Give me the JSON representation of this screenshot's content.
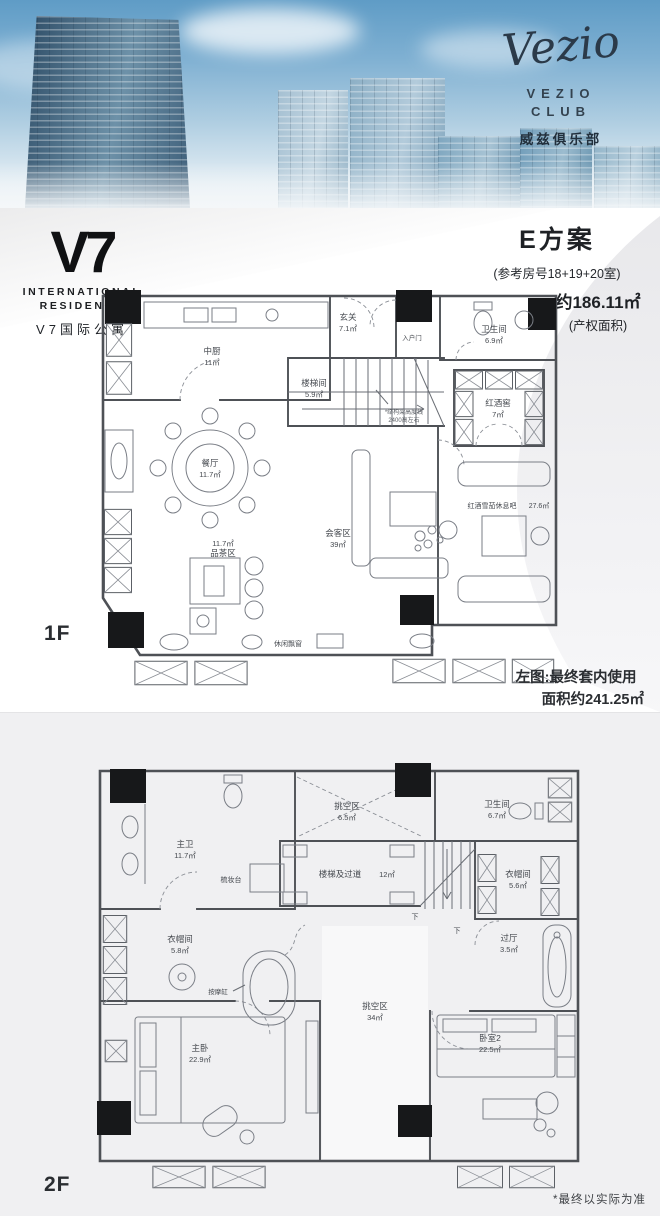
{
  "colors": {
    "sky": "#5f9cc6",
    "plan_line": "#4e5156",
    "column_fill": "#17181a",
    "bottom_section_bg": "#f0f0f2",
    "text_dark": "#1e2125"
  },
  "hero": {
    "brand_script": "Vezio",
    "brand_name": "VEZIO",
    "brand_sub": "CLUB",
    "brand_cn": "威兹俱乐部"
  },
  "logo": {
    "main": "V7",
    "line1": "INTERNATIONAL",
    "line2": "RESIDENCE",
    "cn": "V7国际公寓"
  },
  "plan_header": {
    "title": "E方案",
    "subtitle": "(参考房号18+19+20室)",
    "area": "约186.11㎡",
    "area_note": "(产权面积)"
  },
  "floor1": {
    "label": "1F",
    "note_line1": "左图:最终套内使用",
    "note_line2": "面积约241.25㎡",
    "stair_note_line1": "*结构梁高度线",
    "stair_note_line2": "2400高左右",
    "rooms": {
      "kitchen": {
        "name": "中厨",
        "area": "11㎡"
      },
      "foyer": {
        "name": "玄关",
        "area": "7.1㎡"
      },
      "entry_door": {
        "name": "入户门"
      },
      "stair": {
        "name": "楼梯间",
        "area": "5.9㎡"
      },
      "bath": {
        "name": "卫生间",
        "area": "6.9㎡"
      },
      "wine_cellar": {
        "name": "红酒窖",
        "area": "7㎡"
      },
      "dining": {
        "name": "餐厅",
        "area": "11.7㎡"
      },
      "tea": {
        "name": "品茶区",
        "area": "11.7㎡"
      },
      "reception": {
        "name": "会客区",
        "area": "39㎡"
      },
      "lounge": {
        "name": "红酒雪茄休息吧",
        "area": "27.6㎡"
      },
      "bay": {
        "name": "休闲飘窗"
      }
    }
  },
  "floor2": {
    "label": "2F",
    "disclaimer": "*最终以实际为准",
    "rooms": {
      "master_bath": {
        "name": "主卫",
        "area": "11.7㎡"
      },
      "dresser": {
        "name": "梳妆台"
      },
      "closet1": {
        "name": "衣帽间",
        "area": "5.8㎡"
      },
      "tub": {
        "name": "按摩缸"
      },
      "void_small": {
        "name": "挑空区",
        "area": "6.5㎡"
      },
      "stair": {
        "name": "楼梯及过道",
        "area": "12㎡"
      },
      "bath2": {
        "name": "卫生间",
        "area": "6.7㎡"
      },
      "closet2": {
        "name": "衣帽间",
        "area": "5.6㎡"
      },
      "hall": {
        "name": "过厅",
        "area": "3.5㎡"
      },
      "master": {
        "name": "主卧",
        "area": "22.9㎡"
      },
      "void_large": {
        "name": "挑空区",
        "area": "34㎡"
      },
      "bedroom2": {
        "name": "卧室2",
        "area": "22.5㎡"
      },
      "down1": "下",
      "down2": "下"
    }
  }
}
